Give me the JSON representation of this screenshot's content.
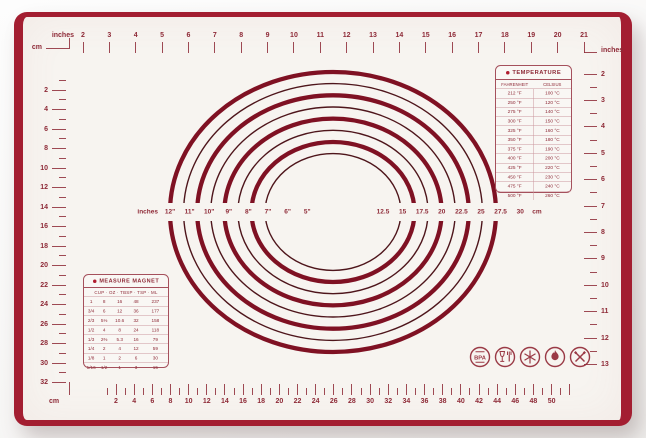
{
  "colors": {
    "frame_red": "#a31e31",
    "marking_red": "#8e2a37",
    "ring_thick": "#7f1123",
    "ring_thin": "#4e151b",
    "mat_background": "#f7f4f0",
    "table_border": "#a5505c"
  },
  "rulers": {
    "top": {
      "unit": "inches",
      "numbers": [
        2,
        3,
        4,
        5,
        6,
        7,
        8,
        9,
        10,
        11,
        12,
        13,
        14,
        15,
        16,
        17,
        18,
        19,
        20,
        21
      ]
    },
    "bottom": {
      "unit": "cm",
      "numbers": [
        2,
        4,
        6,
        8,
        10,
        12,
        14,
        16,
        18,
        20,
        22,
        24,
        26,
        28,
        30,
        32,
        34,
        36,
        38,
        40,
        42,
        44,
        46,
        48,
        50
      ]
    },
    "left": {
      "unit": "cm",
      "numbers": [
        2,
        4,
        6,
        8,
        10,
        12,
        14,
        16,
        18,
        20,
        22,
        24,
        26,
        28,
        30,
        32
      ]
    },
    "right": {
      "unit": "inches",
      "numbers": [
        2,
        3,
        4,
        5,
        6,
        7,
        8,
        9,
        10,
        11,
        12,
        13
      ]
    }
  },
  "circles": {
    "left_unit": "inches",
    "right_unit": "cm",
    "inch_labels": [
      "12\"",
      "11\"",
      "10\"",
      "9\"",
      "8\"",
      "7\"",
      "6\"",
      "5\""
    ],
    "cm_labels": [
      "12.5",
      "15",
      "17.5",
      "20",
      "22.5",
      "25",
      "27.5",
      "30"
    ],
    "diameters_in": [
      12,
      11,
      10,
      9,
      8,
      7,
      6,
      5
    ]
  },
  "temperature_table": {
    "title": "TEMPERATURE",
    "columns": [
      "FAHRENHEIT",
      "CELSIUS"
    ],
    "rows": [
      [
        "212 °F",
        "100 °C"
      ],
      [
        "250 °F",
        "120 °C"
      ],
      [
        "275 °F",
        "140 °C"
      ],
      [
        "300 °F",
        "150 °C"
      ],
      [
        "325 °F",
        "160 °C"
      ],
      [
        "350 °F",
        "180 °C"
      ],
      [
        "375 °F",
        "190 °C"
      ],
      [
        "400 °F",
        "200 °C"
      ],
      [
        "425 °F",
        "220 °C"
      ],
      [
        "450 °F",
        "230 °C"
      ],
      [
        "475 °F",
        "240 °C"
      ],
      [
        "500 °F",
        "260 °C"
      ]
    ]
  },
  "measure_table": {
    "title": "MEASURE MAGNET",
    "columns_display": "CUP · OZ · TBSP · TSP · ML",
    "columns": [
      "CUP",
      "OZ",
      "TBSP",
      "TSP",
      "ML"
    ],
    "rows": [
      [
        "1",
        "8",
        "16",
        "48",
        "237"
      ],
      [
        "3/4",
        "6",
        "12",
        "36",
        "177"
      ],
      [
        "2/3",
        "5⅓",
        "10.6",
        "32",
        "158"
      ],
      [
        "1/2",
        "4",
        "8",
        "24",
        "118"
      ],
      [
        "1/3",
        "2⅔",
        "5.3",
        "16",
        "79"
      ],
      [
        "1/4",
        "2",
        "4",
        "12",
        "59"
      ],
      [
        "1/8",
        "1",
        "2",
        "6",
        "30"
      ],
      [
        "1/16",
        "1/2",
        "1",
        "3",
        "15"
      ]
    ]
  },
  "icons": [
    {
      "name": "bpa-free-icon",
      "label": "BPA"
    },
    {
      "name": "food-safe-icon"
    },
    {
      "name": "freezer-safe-icon"
    },
    {
      "name": "heat-resistant-icon"
    },
    {
      "name": "no-cut-icon"
    }
  ]
}
